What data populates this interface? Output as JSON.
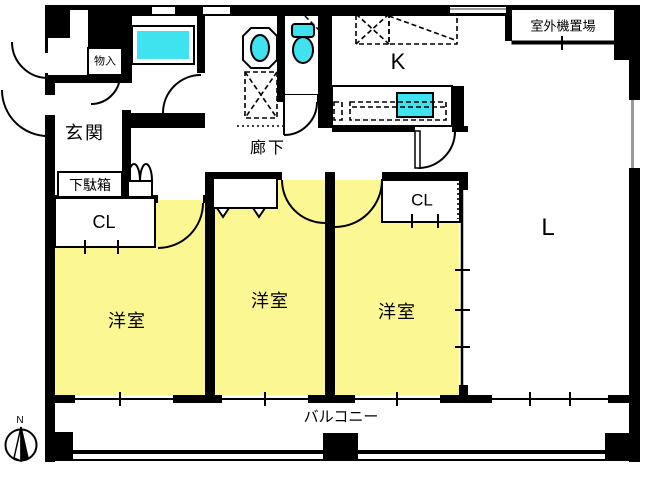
{
  "title": "apartment-floor-plan",
  "colors": {
    "wall": "#000000",
    "floor": "#ffffff",
    "room_yellow": "#fbf894",
    "fixture_cyan": "#3fe2ef",
    "window_gray": "#9a9a9a"
  },
  "labels": {
    "entrance": "玄関",
    "storage": "物入",
    "shoe_cabinet": "下駄箱",
    "hallway": "廊下",
    "kitchen": "K",
    "outdoor_unit_area": "室外機置場",
    "closet_left": "CL",
    "closet_right": "CL",
    "western_room_1": "洋室",
    "western_room_2": "洋室",
    "western_room_3": "洋室",
    "living": "L",
    "balcony": "バルコニー",
    "compass_north": "N"
  }
}
